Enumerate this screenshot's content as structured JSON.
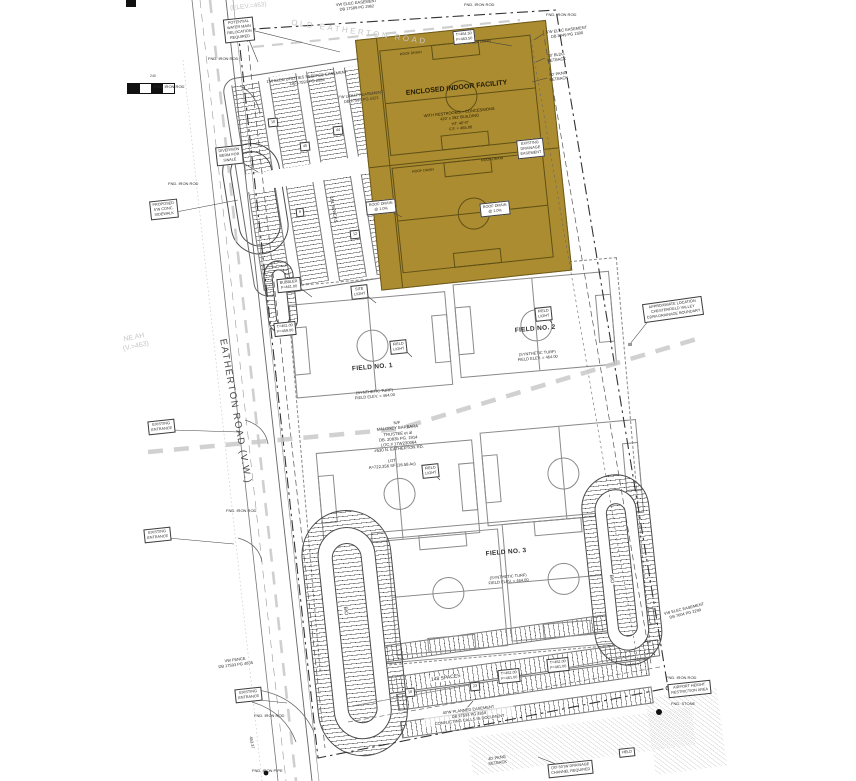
{
  "building": {
    "name": "ENCLOSED INDOOR FACILITY",
    "details": "WITH RESTROOMS + CONCESSIONS\n420' x 392' BUILDING\nHT: 40'-0\"\nF.F. = 465.00",
    "roof_drain": "ROOF DRAIN",
    "roof_drain_note": "ROOF DRAIN\n@ 1.0%",
    "corner_elev": "T=464.50\nF=463.50",
    "drainage_box": "EXISTING\nDRAINAGE\nEASEMENT"
  },
  "fields": {
    "field1": "FIELD NO. 1",
    "field2": "FIELD NO. 2",
    "field3": "FIELD NO. 3",
    "surface_note": "(SYNTHETIC TURF)\nFIELD ELEV. = 464.00"
  },
  "roads": {
    "eatherton": "EATHERTON ROAD (V.W.)",
    "old_eatherton": "OLD EATHERTON ROAD",
    "elev_top": "(ELEV.=463)",
    "elev_left": "NE AH\n(V.=463)"
  },
  "owner": {
    "block": "N/F\nMALONEY BARBARA\nTRUSTEE et al\nDB. 20835 PG. 1914\nLOC.# 17W230064\n#530 N. EATHERTON RD.",
    "lot": "LOT\nA=722,356 SF (16.58 Ac)"
  },
  "parking": {
    "north_count": "181 SPACES",
    "south_count": "148 SPACES",
    "stall_counts": [
      "10",
      "45",
      "44",
      "9",
      "12",
      "18",
      "23"
    ]
  },
  "bio": {
    "label": "BIO"
  },
  "boxes": {
    "water_main": "POTENTIAL\nWATER MAIN\nRELOCATION\nREQUIRED",
    "sidewalk": "PROPOSED\n5'W CONC.\nSIDEWALK",
    "existing_entrance": "EXISTING\nENTRANCE",
    "diversion": "DIVERSION\nBERM FOR\nSWALE",
    "bubbler": "BUBBLER\nF=461.00",
    "site_light": "SITE\nLIGHT",
    "field_light": "FIELD\nLIGHT",
    "tf_461": "T=461.00\nF=459.00",
    "tf_462": "T=462.00\nF=461.00",
    "chesterfield": "APPROXIMATE LOCATION\nCHESTERFIELD VALLEY\nCDRA DRAINAGE BOUNDARY",
    "airport": "AIRPORT HEIGHT\nRESTRICTION AREA",
    "drainage_channel": "(30'-50')W DRAINAGE\nCHANNEL REQUIRED",
    "held": "HELD"
  },
  "notes": {
    "fnd_iron_rod": "FND. IRON ROD",
    "fnd_iron_pipe": "FND. IRON PIPE",
    "fnd_stone": "FND. STONE",
    "elec_top": "VW ELEC EASEMENT\nDB 17589 PG 2962",
    "seepage": "1'W ELEC UTILITIES SEEPAGE EASEMENT\nDB 17593 PG 2826",
    "utility_4323": "7'W UTILITY EASEMENT\nDB 17593 PG 4323",
    "elec_1500": "5'W ELEC EASEMENT\nDB 8049 PG 1500",
    "bldg_setback": "30' BLDG\nSETBACK",
    "pkng_setback": "50' PKNG\nSETBACK",
    "pkng_setback_40": "40' PKNG\nSETBACK",
    "vw_fence": "VW FENCE\nDB 17593 PG 4835",
    "elec_2299": "VW ELEC EASEMENT\nDB 7604 PG 2299",
    "conflict": "40'W PLANNED EASEMENT\nDB 17593 PG 4818\nCONFLICTING CALLS IN DOCUMENT",
    "dim_45337": "453.37",
    "dim_240": "240"
  },
  "colors": {
    "building_fill": "#ac8c31",
    "drainage_dash": "#c9c9c9",
    "linework": "#3f3f3f",
    "faded": "#c6c6c6"
  }
}
